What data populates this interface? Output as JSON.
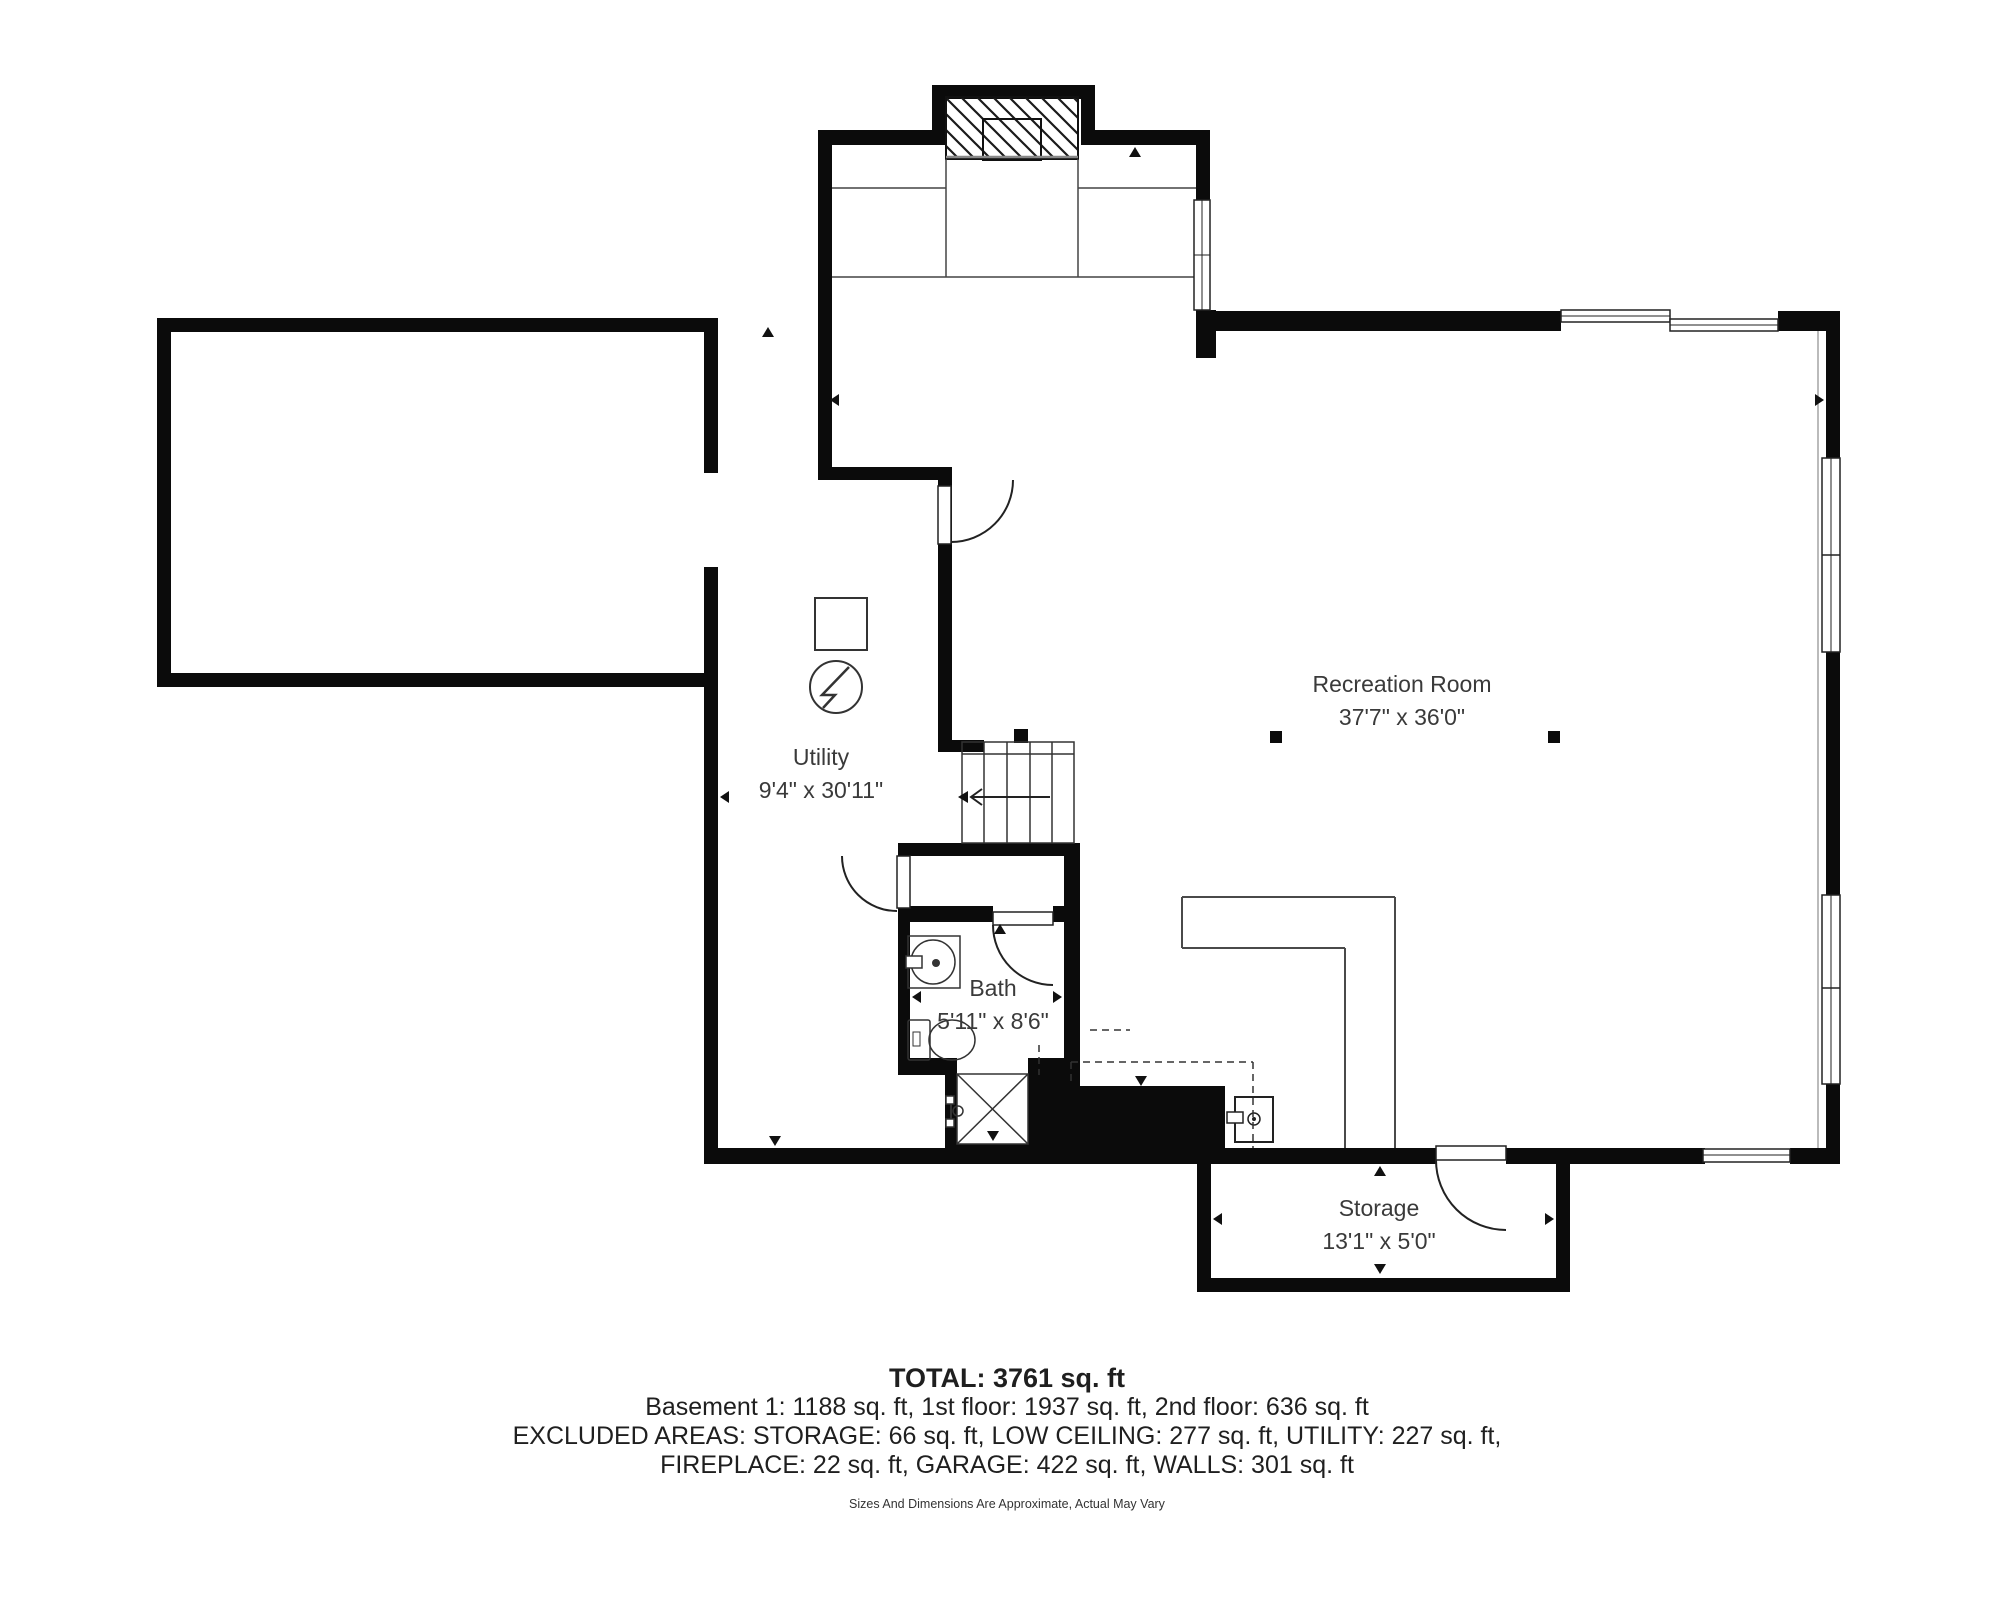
{
  "rooms": {
    "recreation": {
      "name": "Recreation Room",
      "dims": "37'7\" x 36'0\""
    },
    "utility": {
      "name": "Utility",
      "dims": "9'4\" x 30'11\""
    },
    "bath": {
      "name": "Bath",
      "dims": "5'11\" x 8'6\""
    },
    "storage": {
      "name": "Storage",
      "dims": "13'1\" x 5'0\""
    }
  },
  "summary": {
    "total": "TOTAL: 3761 sq. ft",
    "floors": "Basement 1: 1188 sq. ft, 1st floor: 1937 sq. ft, 2nd floor: 636 sq. ft",
    "excluded1": "EXCLUDED AREAS: STORAGE: 66 sq. ft, LOW CEILING: 277 sq. ft, UTILITY: 227 sq. ft,",
    "excluded2": "FIREPLACE: 22 sq. ft, GARAGE: 422 sq. ft, WALLS: 301 sq. ft",
    "disclaimer": "Sizes And Dimensions Are Approximate, Actual May Vary"
  },
  "symbols": {
    "fireplace": "hatched-fireplace",
    "stairs": "stairs-up-arrow",
    "sink": "bathroom-sink",
    "toilet": "toilet",
    "shower": "shower-x",
    "water_heater": "water-heater-square",
    "electrical_panel": "electric-panel-circle-bolt",
    "sump_pump": "sump-pump"
  },
  "colors": {
    "wall": "#0b0b0b",
    "label": "#3a3a3a",
    "thin_line": "#444444"
  }
}
